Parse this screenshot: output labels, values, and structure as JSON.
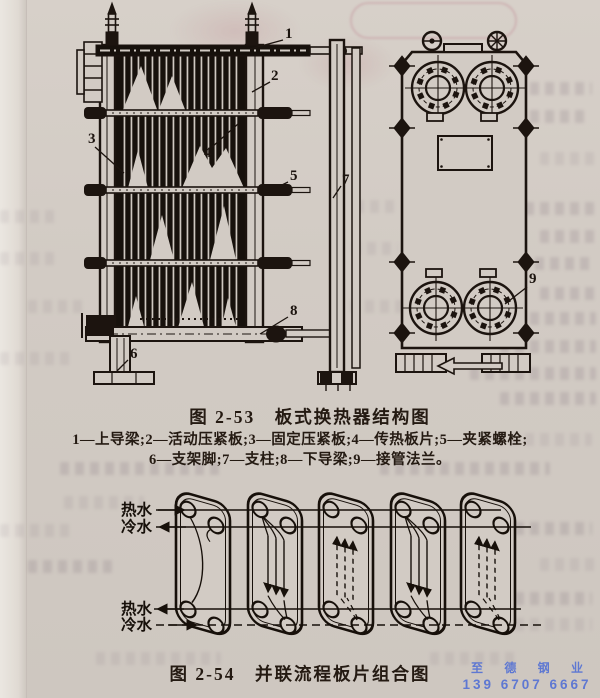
{
  "figure1": {
    "caption": "图 2-53　板式换热器结构图",
    "legend_line1": "1—上导梁;2—活动压紧板;3—固定压紧板;4—传热板片;5—夹紧螺栓;",
    "legend_line2": "6—支架脚;7—支柱;8—下导梁;9—接管法兰。",
    "callouts": [
      "1",
      "2",
      "3",
      "4",
      "5",
      "6",
      "7",
      "8",
      "9"
    ]
  },
  "figure2": {
    "caption": "图 2-54　并联流程板片组合图",
    "labels": {
      "hot_top": "热水",
      "cold_top": "冷水",
      "hot_bottom": "热水",
      "cold_bottom": "冷水"
    }
  },
  "watermark": {
    "company": "至 德 钢 业",
    "phone": "139 6707 6667",
    "color": "#4b6bd6"
  },
  "colors": {
    "ink": "#1c140f",
    "paper": "#d2cbc4",
    "bleedthrough": "#766472"
  }
}
